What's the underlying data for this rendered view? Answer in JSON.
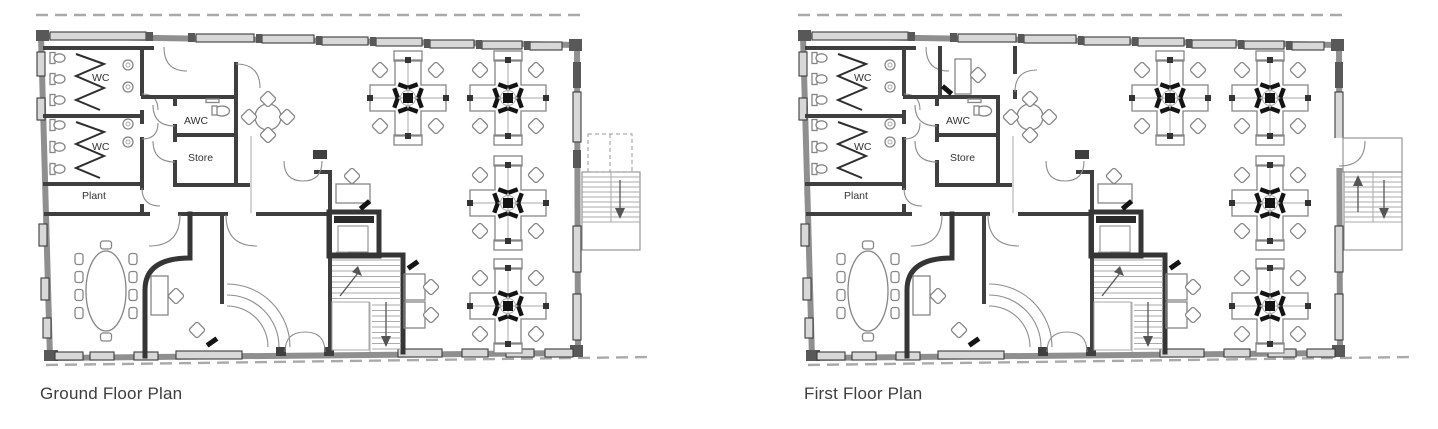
{
  "document": {
    "type": "architectural floor plan sheet",
    "background": "#ffffff"
  },
  "plans": [
    {
      "id": "ground-floor",
      "title": "Ground Floor Plan",
      "rooms": {
        "wc_upper": "WC",
        "wc_lower": "WC",
        "awc": "AWC",
        "store": "Store",
        "plant": "Plant"
      }
    },
    {
      "id": "first-floor",
      "title": "First Floor Plan",
      "rooms": {
        "wc_upper": "WC",
        "wc_lower": "WC",
        "awc": "AWC",
        "store": "Store",
        "plant": "Plant"
      }
    }
  ],
  "colors": {
    "background": "#ffffff",
    "outer_wall": "#8f8f8f",
    "internal_wall": "#3f3f3f",
    "window_fill": "#d8d8d8",
    "furniture_line": "#858585",
    "black_fittings": "#141414",
    "dashed_roofline": "#a9a9a9",
    "label_text": "#333333",
    "caption_text": "#3d3d3d"
  }
}
